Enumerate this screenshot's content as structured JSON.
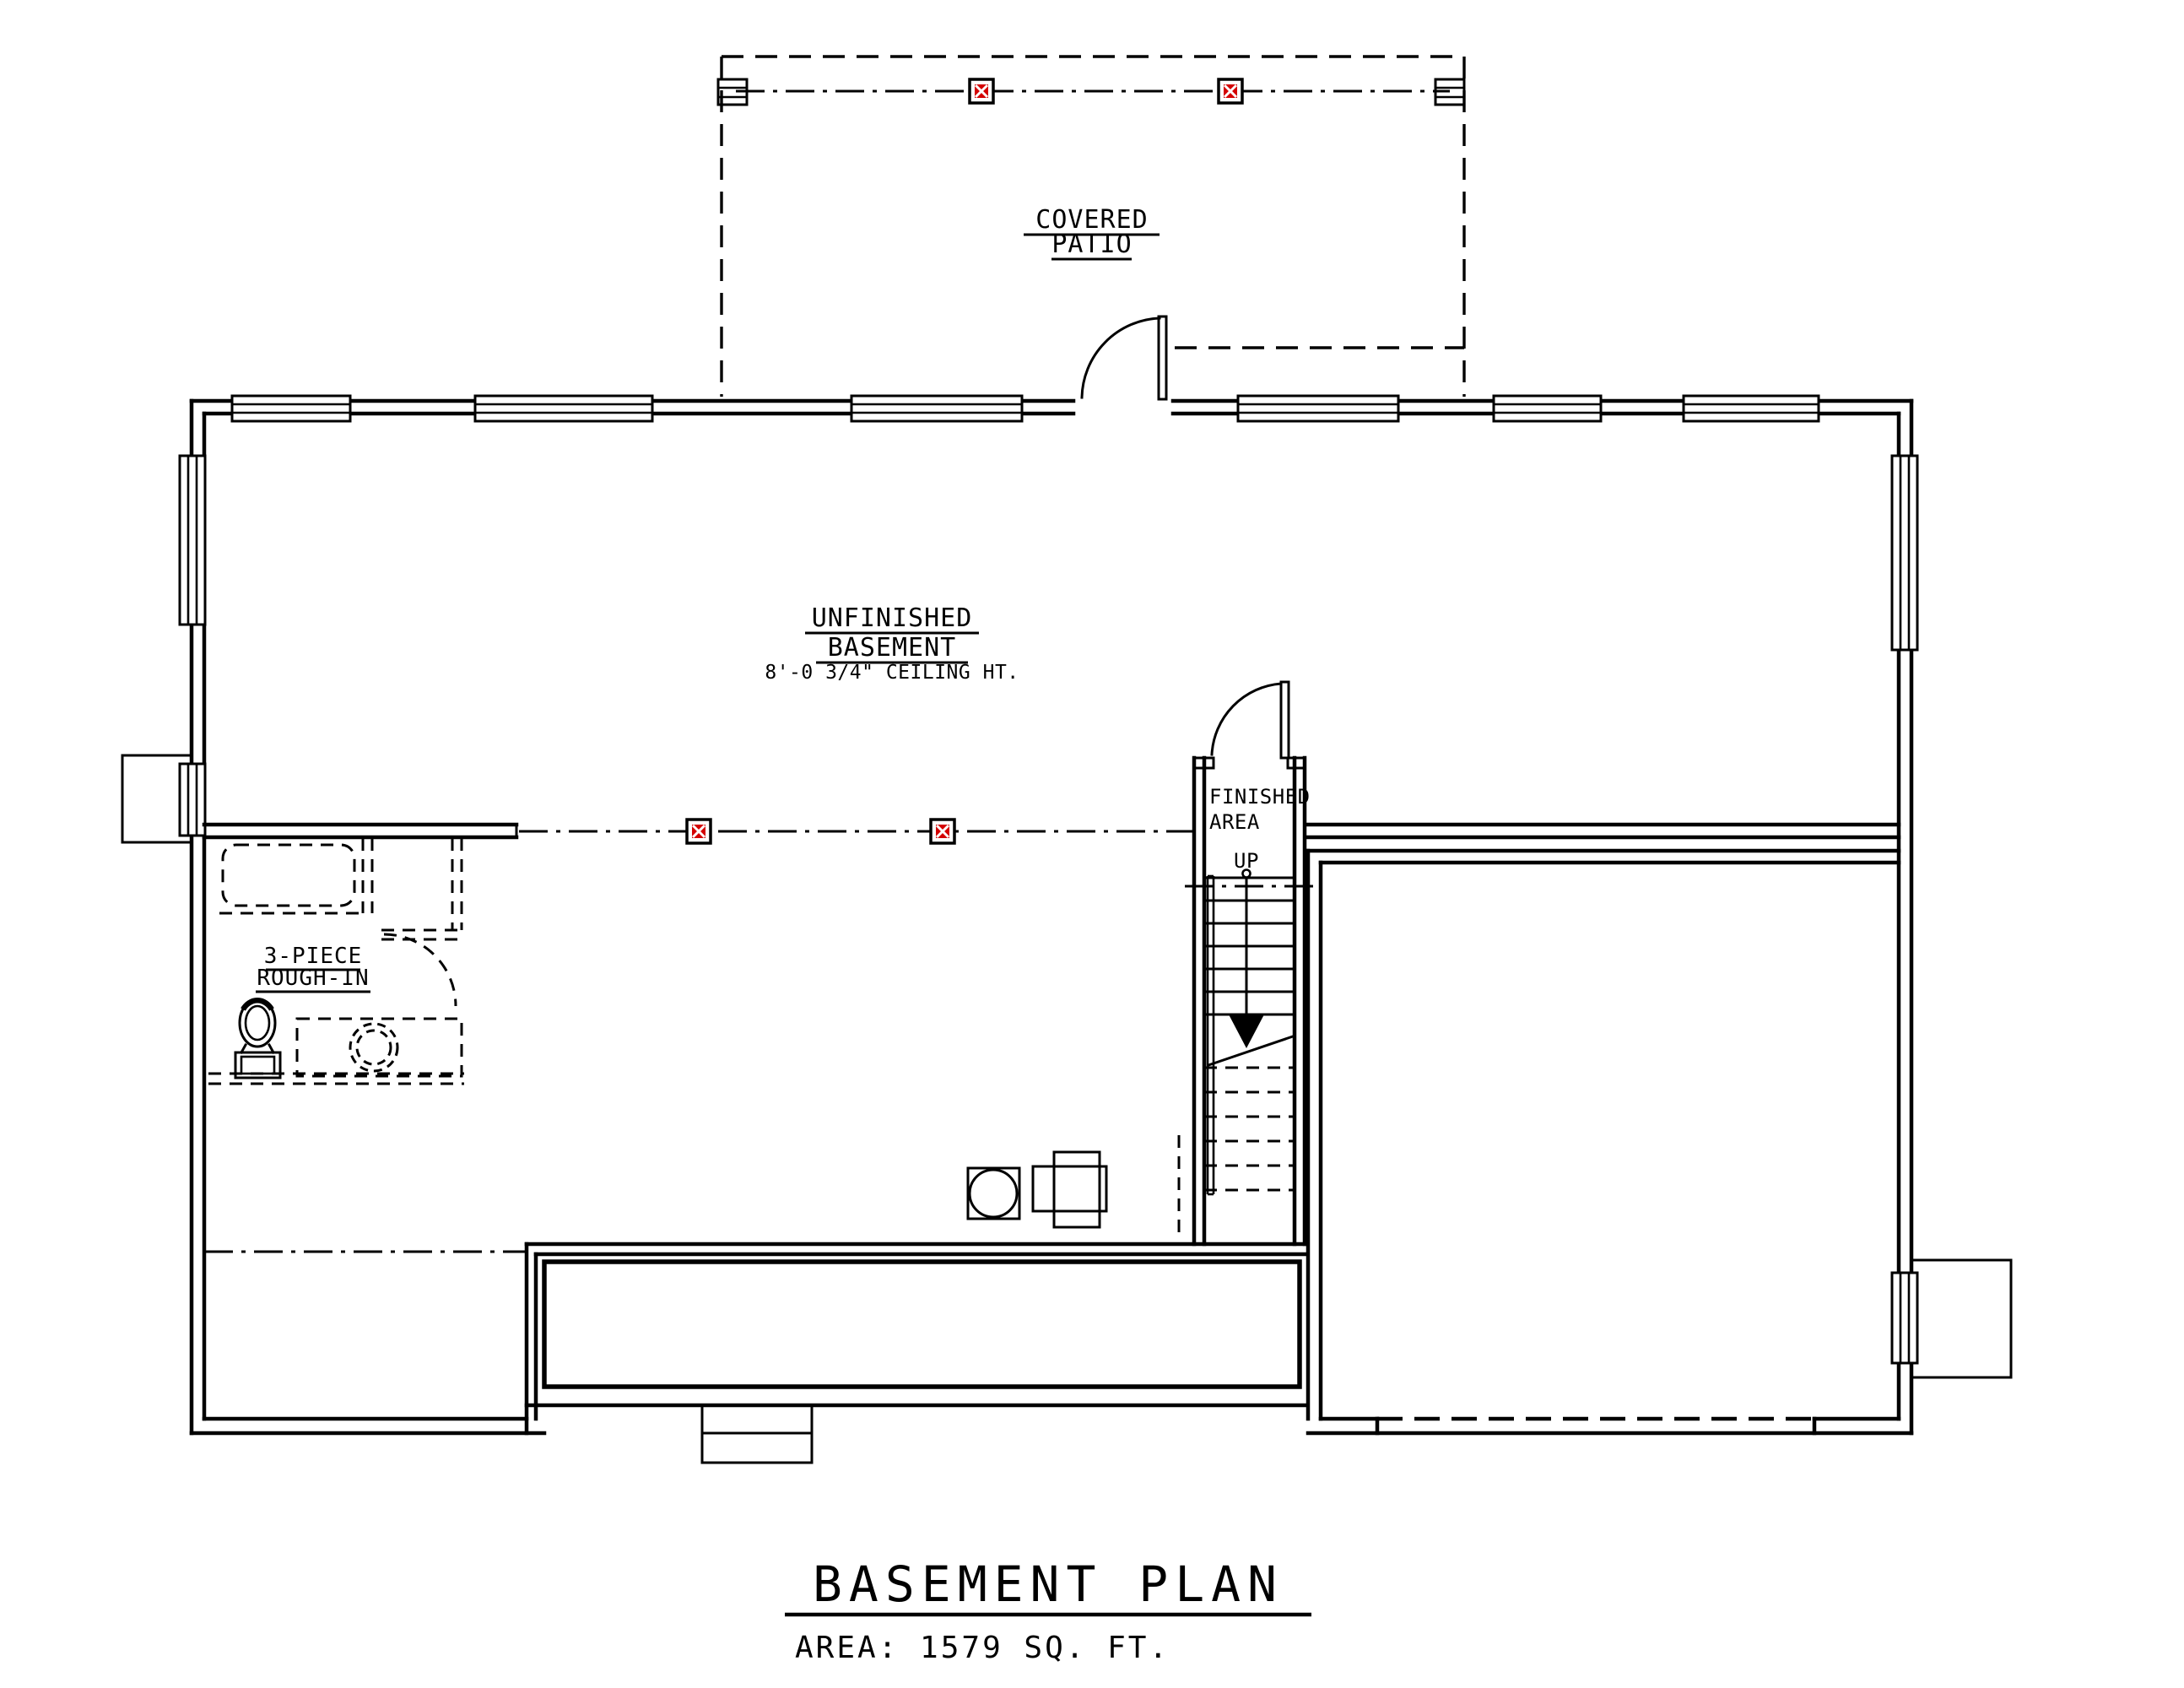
{
  "page": {
    "background": "#ffffff"
  },
  "colors": {
    "line": "#000000",
    "junction_box_red": "#d40000"
  },
  "labels": {
    "covered_patio_1": "COVERED",
    "covered_patio_2": "PATIO",
    "basement_1": "UNFINISHED",
    "basement_2": "BASEMENT",
    "ceiling_note": "8'-0 3/4\" CEILING HT.",
    "finished_area_1": "FINISHED",
    "finished_area_2": "AREA",
    "up": "UP",
    "rough_in_1": "3-PIECE",
    "rough_in_2": "ROUGH-IN"
  },
  "title_block": {
    "title": "BASEMENT PLAN",
    "area": "AREA: 1579 SQ. FT."
  },
  "symbols": {
    "junction_box": "ceiling-junction-box",
    "steel_post": "steel-post-column",
    "beam_line": "dropped-beam-centerline",
    "stair_arrow": "stair-direction-arrow"
  }
}
